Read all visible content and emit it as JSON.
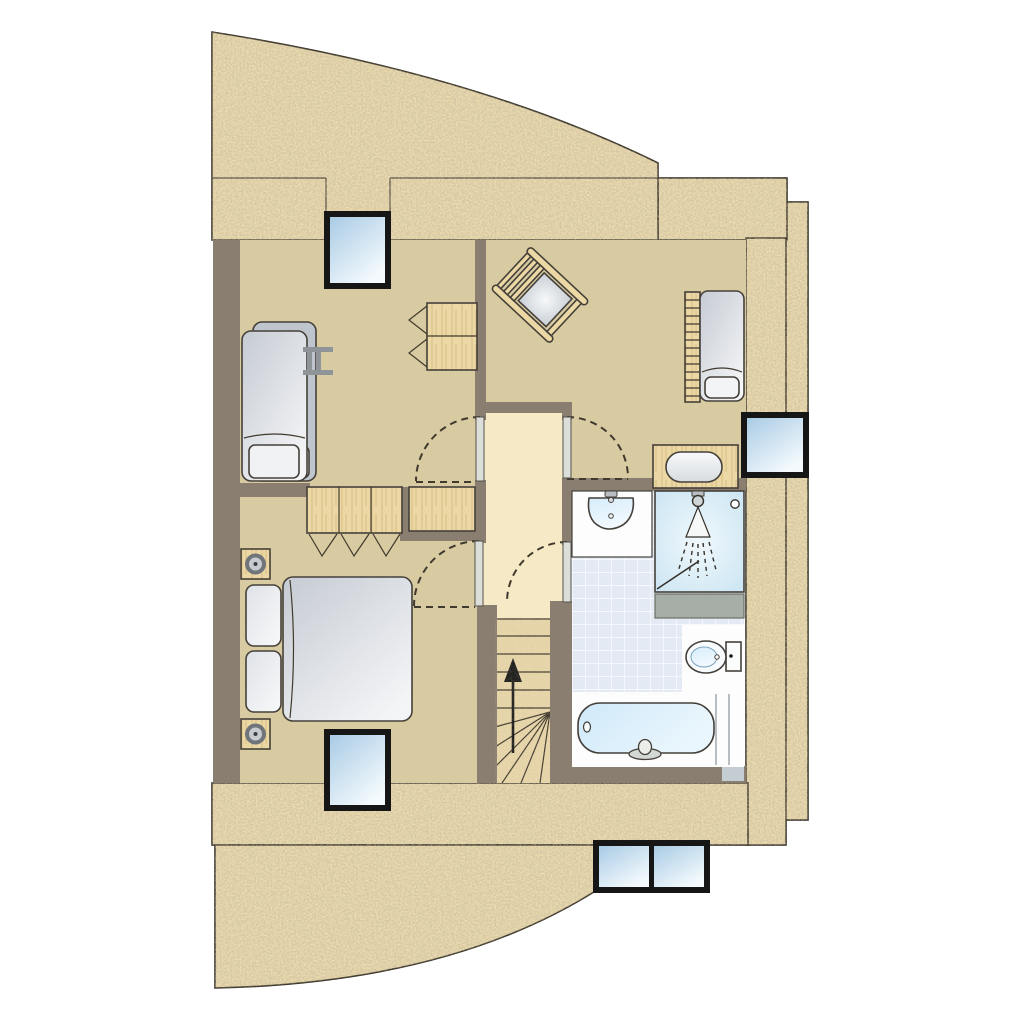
{
  "document": {
    "kind": "architectural-floor-plan",
    "visible_text": "none",
    "floor_arrow": "up"
  },
  "colors": {
    "background": "#ffffff",
    "outer_wall_sand": "#ecdcae",
    "interior_wall_gray": "#8a7e70",
    "room_floor_beige": "#d8cba2",
    "hall_floor_cream": "#f6e9c5",
    "stair_tread": "#ead8ab",
    "wood_furniture": "#ecd8a4",
    "wood_grain_line": "#d9bd85",
    "window_frame": "#161616",
    "window_glass_light": "#f4fafd",
    "window_glass_dark": "#a9cbe5",
    "bathroom_tile": "#e4eaf4",
    "tile_grout": "#fbfcfe",
    "fixture_white": "#fdfdfe",
    "water_blue": "#cfe9f9",
    "shelf_gray": "#a7aea8",
    "bed_linen_gray": "#ccd1d8",
    "outline_dark": "#3a3428"
  },
  "windows": [
    {
      "id": "north-window",
      "panes": 1
    },
    {
      "id": "east-window",
      "panes": 1
    },
    {
      "id": "south-bedroom-window",
      "panes": 1
    },
    {
      "id": "south-east-double-window",
      "panes": 2
    }
  ],
  "rooms": [
    {
      "id": "north-west-room",
      "furniture": [
        "single-bed",
        "single-bed",
        "bunk-ladder",
        "wardrobe"
      ]
    },
    {
      "id": "north-east-room",
      "furniture": [
        "cradle",
        "single-bed",
        "bed-ladder",
        "washstand-basin"
      ]
    },
    {
      "id": "hallway",
      "doors_with_swing_arcs": 4,
      "closets": [
        "triple-door-closet",
        "single-closet"
      ]
    },
    {
      "id": "south-west-bedroom",
      "furniture": [
        "double-bed",
        "pillows",
        "nightstand-lamp",
        "nightstand-lamp"
      ]
    },
    {
      "id": "bathroom",
      "fixtures": [
        "washbasin",
        "shower",
        "ledge",
        "toilet",
        "bathtub"
      ]
    },
    {
      "id": "staircase",
      "features": [
        "straight-treads",
        "winder-treads",
        "up-arrow"
      ]
    }
  ]
}
